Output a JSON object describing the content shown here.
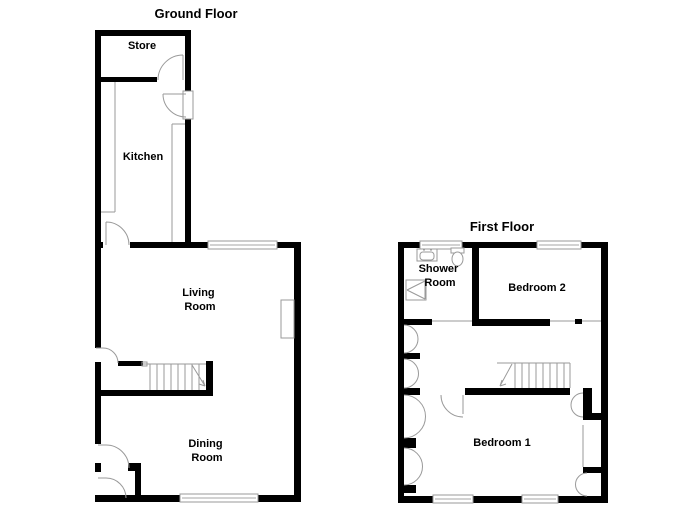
{
  "canvas": {
    "width": 700,
    "height": 509,
    "background": "#ffffff"
  },
  "colors": {
    "wall": "#000000",
    "line": "#9a9a9a",
    "window_line": "#c4c4c4"
  },
  "plans": [
    {
      "id": "ground-floor",
      "title": "Ground Floor",
      "rooms": [
        {
          "id": "store",
          "lines": [
            "Store"
          ]
        },
        {
          "id": "kitchen",
          "lines": [
            "Kitchen"
          ]
        },
        {
          "id": "living-room",
          "lines": [
            "Living",
            "Room"
          ]
        },
        {
          "id": "dining-room",
          "lines": [
            "Dining",
            "Room"
          ]
        }
      ]
    },
    {
      "id": "first-floor",
      "title": "First Floor",
      "rooms": [
        {
          "id": "shower-room",
          "lines": [
            "Shower",
            "Room"
          ]
        },
        {
          "id": "bedroom-2",
          "lines": [
            "Bedroom 2"
          ]
        },
        {
          "id": "bedroom-1",
          "lines": [
            "Bedroom 1"
          ]
        }
      ]
    }
  ]
}
